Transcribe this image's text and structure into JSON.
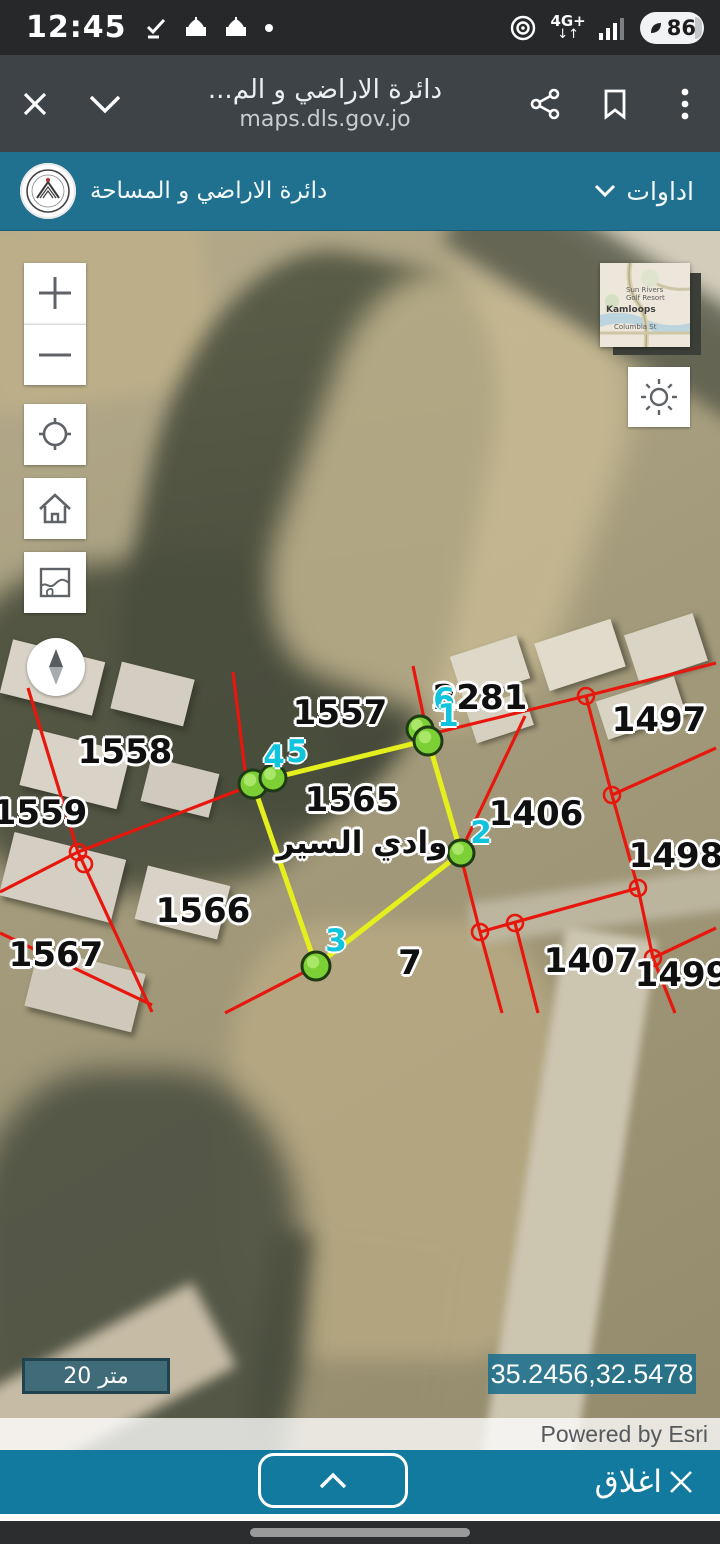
{
  "status_bar": {
    "time": "12:45",
    "network": "4G+",
    "battery": "86"
  },
  "browser": {
    "title": "دائرة الاراضي و الم...",
    "url": "maps.dls.gov.jo"
  },
  "header": {
    "org_name": "دائرة الاراضي و المساحة",
    "tools_label": "اداوات"
  },
  "map": {
    "minimap_labels": {
      "city": "Kamloops",
      "poi": "Sun Rivers Golf Resort",
      "street": "Columbia St"
    },
    "place_label": "وادي السير",
    "place_label_pos": {
      "x": 362,
      "y": 843
    },
    "scale_label": "20 متر",
    "coordinates": "35.2456,32.5478",
    "attribution": "Powered by Esri",
    "parcel_labels": [
      {
        "text": "1557",
        "x": 340,
        "y": 713
      },
      {
        "text": "2281",
        "x": 480,
        "y": 698
      },
      {
        "text": "1497",
        "x": 659,
        "y": 720
      },
      {
        "text": "1558",
        "x": 125,
        "y": 752
      },
      {
        "text": "1559",
        "x": 40,
        "y": 813
      },
      {
        "text": "1565",
        "x": 352,
        "y": 800
      },
      {
        "text": "1406",
        "x": 536,
        "y": 814
      },
      {
        "text": "1498",
        "x": 676,
        "y": 856
      },
      {
        "text": "1566",
        "x": 203,
        "y": 911
      },
      {
        "text": "1567",
        "x": 56,
        "y": 955
      },
      {
        "text": "7",
        "x": 410,
        "y": 963
      },
      {
        "text": "1407",
        "x": 591,
        "y": 961
      },
      {
        "text": "1499",
        "x": 682,
        "y": 975
      }
    ],
    "vertex_labels": [
      {
        "n": "6",
        "x": 444,
        "y": 700
      },
      {
        "n": "1",
        "x": 448,
        "y": 716
      },
      {
        "n": "2",
        "x": 481,
        "y": 833
      },
      {
        "n": "3",
        "x": 336,
        "y": 941
      },
      {
        "n": "4",
        "x": 274,
        "y": 757
      },
      {
        "n": "5",
        "x": 297,
        "y": 752
      }
    ],
    "vertex_points": [
      [
        420,
        729,
        13
      ],
      [
        428,
        741,
        14
      ],
      [
        253,
        784,
        14
      ],
      [
        273,
        778,
        13
      ],
      [
        461,
        853,
        13
      ],
      [
        316,
        966,
        14
      ]
    ],
    "polygon": [
      [
        428,
        740
      ],
      [
        461,
        853
      ],
      [
        316,
        966
      ],
      [
        253,
        784
      ],
      [
        273,
        778
      ]
    ],
    "red_lines": [
      [
        28,
        688,
        78,
        852
      ],
      [
        78,
        852,
        152,
        1012
      ],
      [
        0,
        892,
        78,
        852
      ],
      [
        78,
        852,
        247,
        787
      ],
      [
        247,
        787,
        233,
        672
      ],
      [
        413,
        666,
        427,
        733
      ],
      [
        427,
        735,
        586,
        696
      ],
      [
        586,
        696,
        716,
        663
      ],
      [
        525,
        716,
        460,
        853
      ],
      [
        460,
        853,
        480,
        932
      ],
      [
        480,
        932,
        502,
        1013
      ],
      [
        480,
        932,
        638,
        888
      ],
      [
        515,
        923,
        538,
        1013
      ],
      [
        586,
        696,
        612,
        795
      ],
      [
        612,
        795,
        638,
        888
      ],
      [
        612,
        795,
        716,
        748
      ],
      [
        638,
        888,
        653,
        958
      ],
      [
        653,
        958,
        675,
        1013
      ],
      [
        653,
        958,
        716,
        928
      ],
      [
        225,
        1013,
        316,
        966
      ],
      [
        0,
        933,
        152,
        1005
      ]
    ],
    "red_circles": [
      [
        78,
        852
      ],
      [
        84,
        864
      ],
      [
        247,
        787
      ],
      [
        480,
        932
      ],
      [
        515,
        923
      ],
      [
        586,
        696
      ],
      [
        612,
        795
      ],
      [
        638,
        888
      ],
      [
        653,
        958
      ]
    ],
    "colors": {
      "polygon": "#e4ef1d",
      "cadastre": "#e8170d",
      "vertex_fill": "#7ccf35",
      "vertex_ring": "#1e3b14",
      "vertex_label": "#10c4de"
    }
  },
  "footer": {
    "close_label": "اغلاق"
  }
}
